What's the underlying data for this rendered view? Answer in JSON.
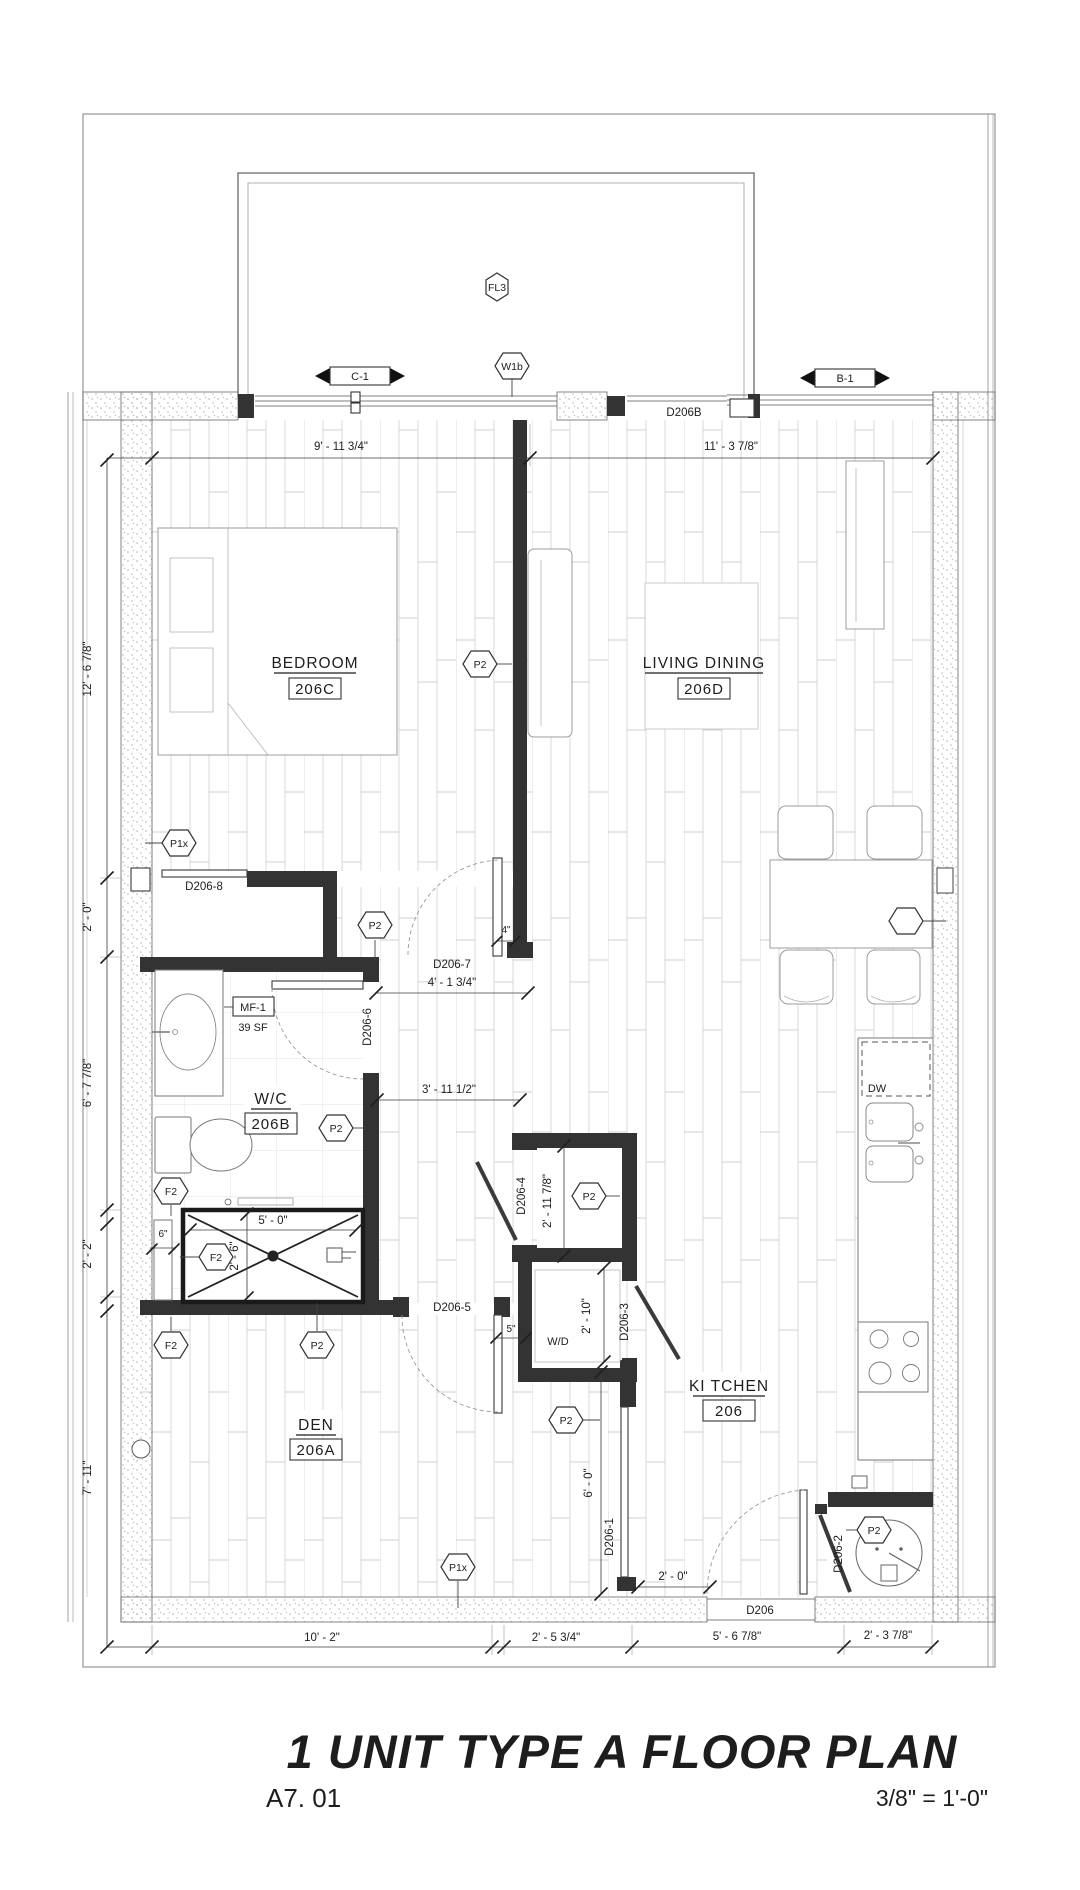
{
  "title_block": {
    "title": "1 UNIT TYPE A FLOOR PLAN",
    "sheet_number": "A7. 01",
    "scale": "3/8\" = 1'-0\""
  },
  "rooms": [
    {
      "name": "BEDROOM",
      "number": "206C"
    },
    {
      "name": "LIVING DINING",
      "number": "206D"
    },
    {
      "name": "W/C",
      "number": "206B"
    },
    {
      "name": "KI TCHEN",
      "number": "206"
    },
    {
      "name": "DEN",
      "number": "206A"
    }
  ],
  "doors": {
    "d206b": "D206B",
    "d206": "D206",
    "d206_1": "D206-1",
    "d206_2": "D206-2",
    "d206_3": "D206-3",
    "d206_4": "D206-4",
    "d206_5": "D206-5",
    "d206_6": "D206-6",
    "d206_7": "D206-7",
    "d206_8": "D206-8"
  },
  "tags": {
    "fl3": "FL3",
    "w1b": "W1b",
    "c1": "C-1",
    "b1": "B-1",
    "p1x": "P1x",
    "p2": "P2",
    "f2": "F2",
    "mf1": "MF-1",
    "area_sf": "39 SF",
    "dw": "DW",
    "wd": "W/D"
  },
  "dims": {
    "top_bedroom": "9' - 11 3/4\"",
    "top_living": "11' - 3 7/8\"",
    "left_1": "12' - 6 7/8\"",
    "left_2": "2' - 0\"",
    "left_3": "6' - 7 7/8\"",
    "left_4": "2' - 2\"",
    "left_5": "7' - 11\"",
    "bottom_1": "10' - 2\"",
    "bottom_2": "2' - 5 3/4\"",
    "bottom_3": "5' - 6 7/8\"",
    "bottom_4": "2' - 3 7/8\"",
    "hall_upper": "4' - 1 3/4\"",
    "hall_lower": "3' - 11 1/2\"",
    "door_gap": "4\"",
    "shower_w": "5' - 0\"",
    "shower_d": "2' - 6\"",
    "curb": "6\"",
    "closet_d": "2' - 11 7/8\"",
    "wd_d": "2' - 10\"",
    "kitchen_h": "6' - 0\"",
    "entry": "2' - 0\""
  }
}
